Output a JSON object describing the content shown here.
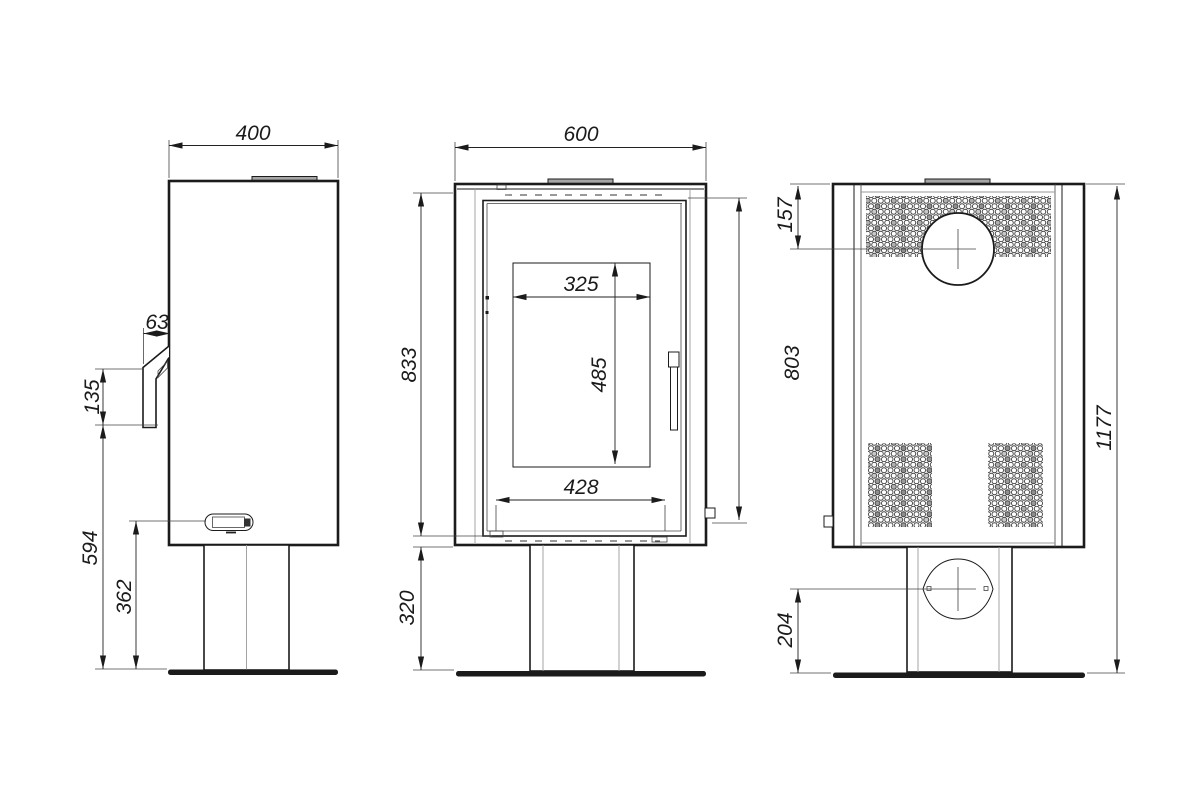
{
  "drawing": {
    "type": "technical-orthographic-drawing",
    "subject": "freestanding stove with pedestal base",
    "views": {
      "side": {
        "label": "side view"
      },
      "front": {
        "label": "front view"
      },
      "rear": {
        "label": "rear view"
      }
    }
  },
  "dims": {
    "side_width": "400",
    "handle_depth": "63",
    "handle_height": "135",
    "handle_to_floor": "594",
    "control_to_floor": "362",
    "front_width": "600",
    "body_height": "833",
    "pedestal_height": "320",
    "glass_width": "325",
    "glass_height": "485",
    "firebox_width": "428",
    "door_height": "803",
    "flue_center_offset": "157",
    "total_height": "1177",
    "inlet_center_height": "204"
  },
  "colors": {
    "ink": "#1b1b1b",
    "thin_line": "#444444",
    "construction_gray": "#9a9a9a",
    "tab_fill": "#a6a6a6",
    "background": "#ffffff"
  }
}
